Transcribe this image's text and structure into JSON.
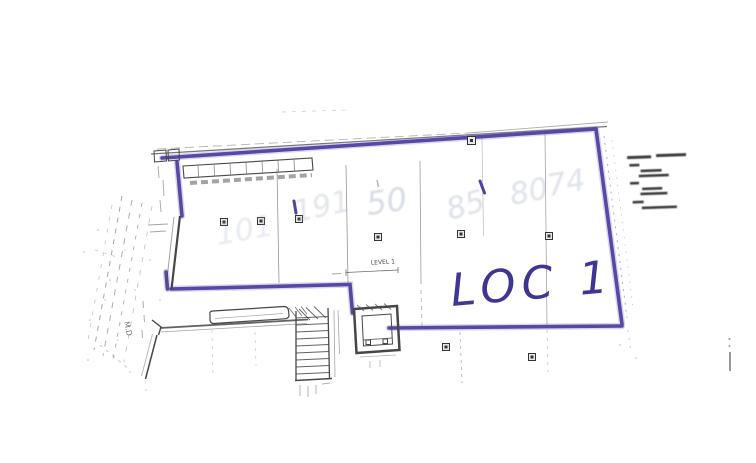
{
  "plan": {
    "loc_label": "LOC 1",
    "level_label": "LEVEL 1",
    "side_label": "M.D",
    "handwritten_numbers": [
      "101",
      "191",
      "50",
      "85",
      "80",
      "74"
    ],
    "colors": {
      "highlighter": "#4b3d9e",
      "highlighter_halo": "#8d86c6",
      "pen": "#352c8e",
      "pencil": "#98a0c2",
      "ink": "#474747"
    }
  }
}
